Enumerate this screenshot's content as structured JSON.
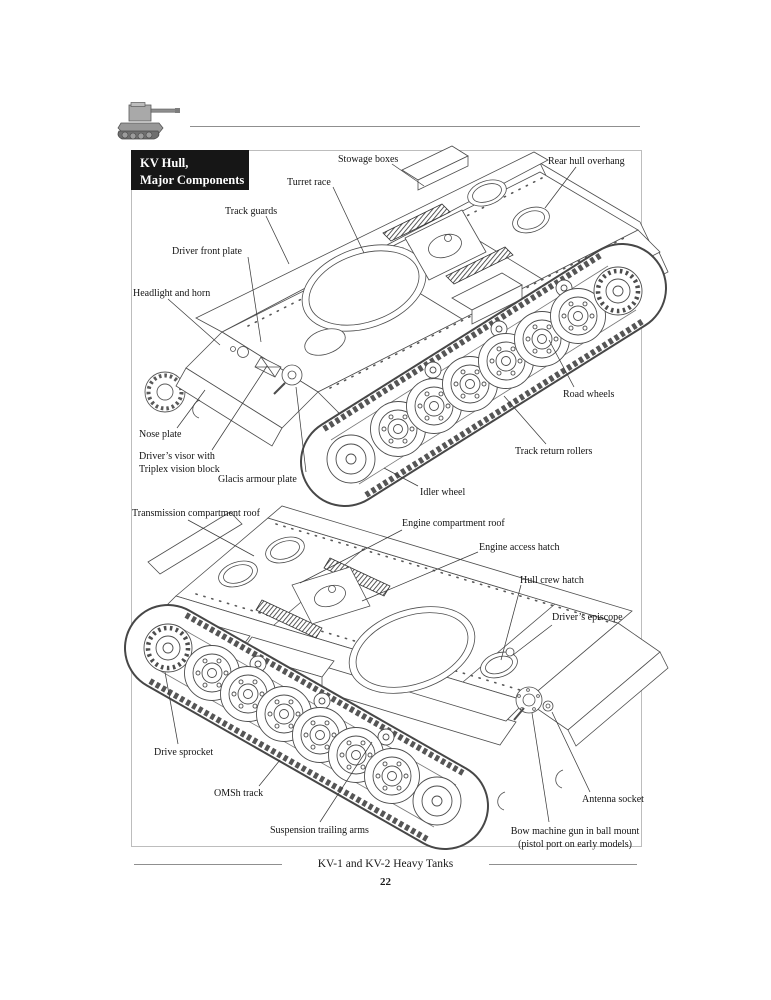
{
  "header": {
    "icon": "kv2-tank-photo-icon"
  },
  "title_box": {
    "text": "KV Hull,\nMajor Components"
  },
  "diagram_top": {
    "description": "KV hull isometric line drawing, front-left view",
    "labels": [
      {
        "text": "Stowage boxes"
      },
      {
        "text": "Rear hull overhang"
      },
      {
        "text": "Turret race"
      },
      {
        "text": "Track guards"
      },
      {
        "text": "Driver front plate"
      },
      {
        "text": "Headlight and horn"
      },
      {
        "text": "Nose plate"
      },
      {
        "text": "Driver’s visor with\nTriplex vision block"
      },
      {
        "text": "Glacis armour plate"
      },
      {
        "text": "Road wheels"
      },
      {
        "text": "Track return rollers"
      },
      {
        "text": "Idler wheel"
      }
    ]
  },
  "diagram_bottom": {
    "description": "KV hull isometric line drawing, rear-left view",
    "labels": [
      {
        "text": "Transmission compartment roof"
      },
      {
        "text": "Engine compartment roof"
      },
      {
        "text": "Engine access hatch"
      },
      {
        "text": "Hull crew hatch"
      },
      {
        "text": "Driver’s episcope"
      },
      {
        "text": "Drive sprocket"
      },
      {
        "text": "OMSh track"
      },
      {
        "text": "Suspension trailing arms"
      },
      {
        "text": "Antenna socket"
      },
      {
        "text": "Bow machine gun in ball mount\n(pistol port on early models)"
      }
    ]
  },
  "footer": {
    "book_title": "KV-1 and KV-2 Heavy Tanks",
    "page_number": "22"
  }
}
